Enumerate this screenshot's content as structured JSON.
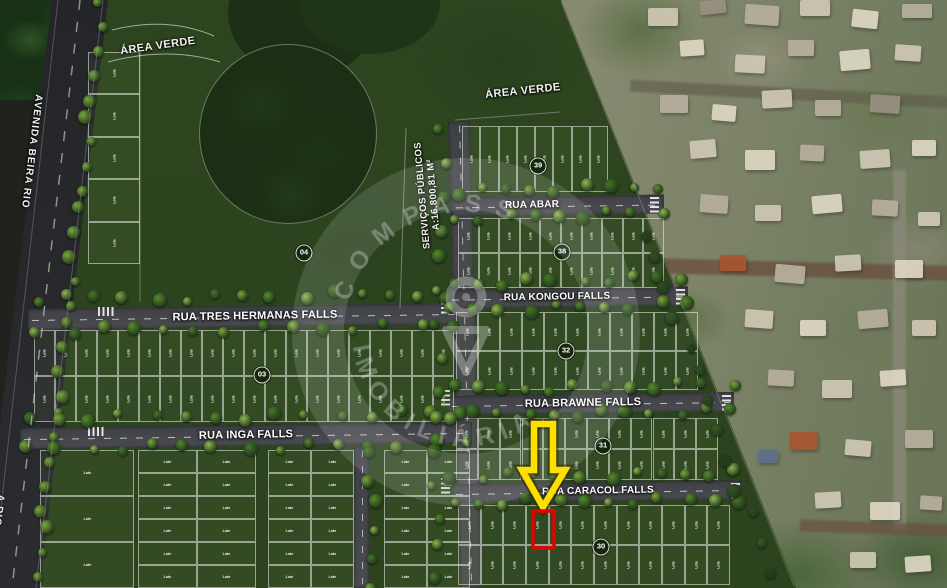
{
  "map": {
    "area_verde_top_left": "ÁREA VERDE",
    "area_verde_center": "ÁREA VERDE",
    "avenue_label": "AVENIDA BEIRA RIO",
    "avenue_label_partial": "A RIO",
    "servicos_line1": "SERVIÇOS PÚBLICOS",
    "servicos_line2": "A:16.800,81 M²",
    "lot_label": "Lote"
  },
  "streets": [
    {
      "id": "tres-hermanas",
      "label": "RUA TRES HERMANAS FALLS"
    },
    {
      "id": "inga",
      "label": "RUA INGA FALLS"
    },
    {
      "id": "abar",
      "label": "RUA ABAR"
    },
    {
      "id": "kongou",
      "label": "RUA KONGOU FALLS"
    },
    {
      "id": "brawne",
      "label": "RUA BRAWNE FALLS"
    },
    {
      "id": "caracol",
      "label": "RUA CARACOL FALLS"
    }
  ],
  "badges": [
    {
      "number": "04"
    },
    {
      "number": "03"
    },
    {
      "number": "39"
    },
    {
      "number": "38"
    },
    {
      "number": "32"
    },
    {
      "number": "31"
    },
    {
      "number": "30"
    }
  ],
  "watermark": {
    "text_top": "COMPASS",
    "text_bottom": "IMOBILIÁRIA",
    "icon": "compass-icon"
  },
  "highlight": {
    "arrow_color": "#ffdf00",
    "lot_outline_color": "#e60000"
  },
  "colors": {
    "plat_green": "#2c431f",
    "road_gray": "#45464b",
    "label_white": "#ffffff"
  },
  "render": {
    "lot_blocks": [
      {
        "x": 462,
        "y": 126,
        "w": 146,
        "h": 66,
        "rows": 1,
        "cols": 8,
        "v": true
      },
      {
        "x": 458,
        "y": 218,
        "w": 206,
        "h": 70,
        "rows": 2,
        "cols": 10,
        "v": true
      },
      {
        "x": 456,
        "y": 312,
        "w": 242,
        "h": 78,
        "rows": 2,
        "cols": 11,
        "v": true
      },
      {
        "x": 456,
        "y": 418,
        "w": 262,
        "h": 62,
        "rows": 2,
        "cols": 12,
        "v": true
      },
      {
        "x": 458,
        "y": 505,
        "w": 272,
        "h": 80,
        "rows": 2,
        "cols": 12,
        "v": true
      },
      {
        "x": 34,
        "y": 330,
        "w": 420,
        "h": 92,
        "rows": 2,
        "cols": 20,
        "v": true
      },
      {
        "x": 88,
        "y": 52,
        "w": 52,
        "h": 212,
        "rows": 5,
        "cols": 1,
        "v": true
      },
      {
        "x": 138,
        "y": 450,
        "w": 118,
        "h": 138,
        "rows": 6,
        "cols": 2,
        "v": false
      },
      {
        "x": 268,
        "y": 450,
        "w": 86,
        "h": 138,
        "rows": 6,
        "cols": 2,
        "v": false
      },
      {
        "x": 384,
        "y": 450,
        "w": 86,
        "h": 138,
        "rows": 6,
        "cols": 2,
        "v": false
      },
      {
        "x": 40,
        "y": 450,
        "w": 94,
        "h": 138,
        "rows": 3,
        "cols": 1,
        "v": false
      }
    ],
    "tree_belts": [
      [
        102,
        6,
        38,
        576,
        26,
        2
      ],
      [
        38,
        299,
        450,
        294,
        15,
        0
      ],
      [
        38,
        331,
        450,
        326,
        14,
        0
      ],
      [
        28,
        419,
        464,
        413,
        15,
        0
      ],
      [
        28,
        449,
        464,
        444,
        15,
        0
      ],
      [
        456,
        191,
        660,
        187,
        9,
        0
      ],
      [
        456,
        217,
        660,
        213,
        9,
        0
      ],
      [
        450,
        283,
        684,
        279,
        10,
        0
      ],
      [
        450,
        309,
        684,
        305,
        10,
        0
      ],
      [
        450,
        389,
        730,
        385,
        12,
        0
      ],
      [
        450,
        415,
        730,
        411,
        12,
        0
      ],
      [
        454,
        477,
        738,
        473,
        12,
        0
      ],
      [
        454,
        503,
        738,
        499,
        12,
        0
      ],
      [
        442,
        132,
        434,
        580,
        15,
        0
      ],
      [
        644,
        232,
        770,
        572,
        13,
        1
      ],
      [
        372,
        450,
        372,
        585,
        6,
        0
      ]
    ],
    "tree_palettes": [
      [
        "#79a53e",
        "#568a2d",
        "#8fb84f",
        "#46752a"
      ],
      [
        "#2f4c22",
        "#3c5c2a",
        "#27401d",
        "#355226"
      ],
      [
        "#79a53e",
        "#a04a38",
        "#568a2d",
        "#7e3b2e",
        "#8fb84f"
      ]
    ],
    "roofs": [
      [
        648,
        8,
        30,
        18,
        0,
        0
      ],
      [
        700,
        0,
        26,
        14,
        -6,
        3
      ],
      [
        745,
        5,
        34,
        20,
        4,
        1
      ],
      [
        800,
        0,
        30,
        16,
        0,
        0
      ],
      [
        852,
        10,
        26,
        18,
        6,
        2
      ],
      [
        902,
        4,
        30,
        14,
        0,
        1
      ],
      [
        680,
        40,
        24,
        16,
        -4,
        2
      ],
      [
        735,
        55,
        30,
        18,
        3,
        0
      ],
      [
        788,
        40,
        26,
        16,
        0,
        1
      ],
      [
        840,
        50,
        30,
        20,
        -5,
        2
      ],
      [
        895,
        45,
        26,
        16,
        4,
        0
      ],
      [
        660,
        95,
        28,
        18,
        0,
        1
      ],
      [
        712,
        105,
        24,
        16,
        5,
        2
      ],
      [
        762,
        90,
        30,
        18,
        -3,
        0
      ],
      [
        815,
        100,
        26,
        16,
        0,
        1
      ],
      [
        870,
        95,
        30,
        18,
        4,
        3
      ],
      [
        690,
        140,
        26,
        18,
        -5,
        0
      ],
      [
        745,
        150,
        30,
        20,
        0,
        2
      ],
      [
        800,
        145,
        24,
        16,
        3,
        1
      ],
      [
        860,
        150,
        30,
        18,
        -4,
        0
      ],
      [
        912,
        140,
        24,
        16,
        0,
        2
      ],
      [
        700,
        195,
        28,
        18,
        4,
        1
      ],
      [
        755,
        205,
        26,
        16,
        0,
        0
      ],
      [
        812,
        195,
        30,
        18,
        -5,
        2
      ],
      [
        872,
        200,
        26,
        16,
        3,
        1
      ],
      [
        918,
        212,
        22,
        14,
        0,
        0
      ],
      [
        720,
        255,
        26,
        16,
        0,
        4
      ],
      [
        775,
        265,
        30,
        18,
        5,
        1
      ],
      [
        835,
        255,
        26,
        16,
        -3,
        0
      ],
      [
        895,
        260,
        28,
        18,
        0,
        2
      ],
      [
        745,
        310,
        28,
        18,
        4,
        0
      ],
      [
        800,
        320,
        26,
        16,
        0,
        2
      ],
      [
        858,
        310,
        30,
        18,
        -5,
        1
      ],
      [
        912,
        320,
        24,
        16,
        0,
        0
      ],
      [
        768,
        370,
        26,
        16,
        3,
        1
      ],
      [
        822,
        380,
        30,
        18,
        0,
        0
      ],
      [
        880,
        370,
        26,
        16,
        -4,
        2
      ],
      [
        790,
        432,
        28,
        18,
        0,
        4
      ],
      [
        845,
        440,
        26,
        16,
        5,
        0
      ],
      [
        905,
        430,
        28,
        18,
        0,
        1
      ],
      [
        758,
        450,
        20,
        13,
        0,
        5
      ],
      [
        815,
        492,
        26,
        16,
        -3,
        0
      ],
      [
        870,
        502,
        30,
        18,
        0,
        2
      ],
      [
        920,
        496,
        22,
        14,
        4,
        1
      ],
      [
        850,
        552,
        26,
        16,
        0,
        0
      ],
      [
        905,
        556,
        26,
        16,
        -4,
        2
      ]
    ],
    "roof_colors": [
      "#cfc8b4",
      "#b7af9d",
      "#ded7c3",
      "#97907f",
      "#a8552f",
      "#5d6f8a"
    ]
  }
}
